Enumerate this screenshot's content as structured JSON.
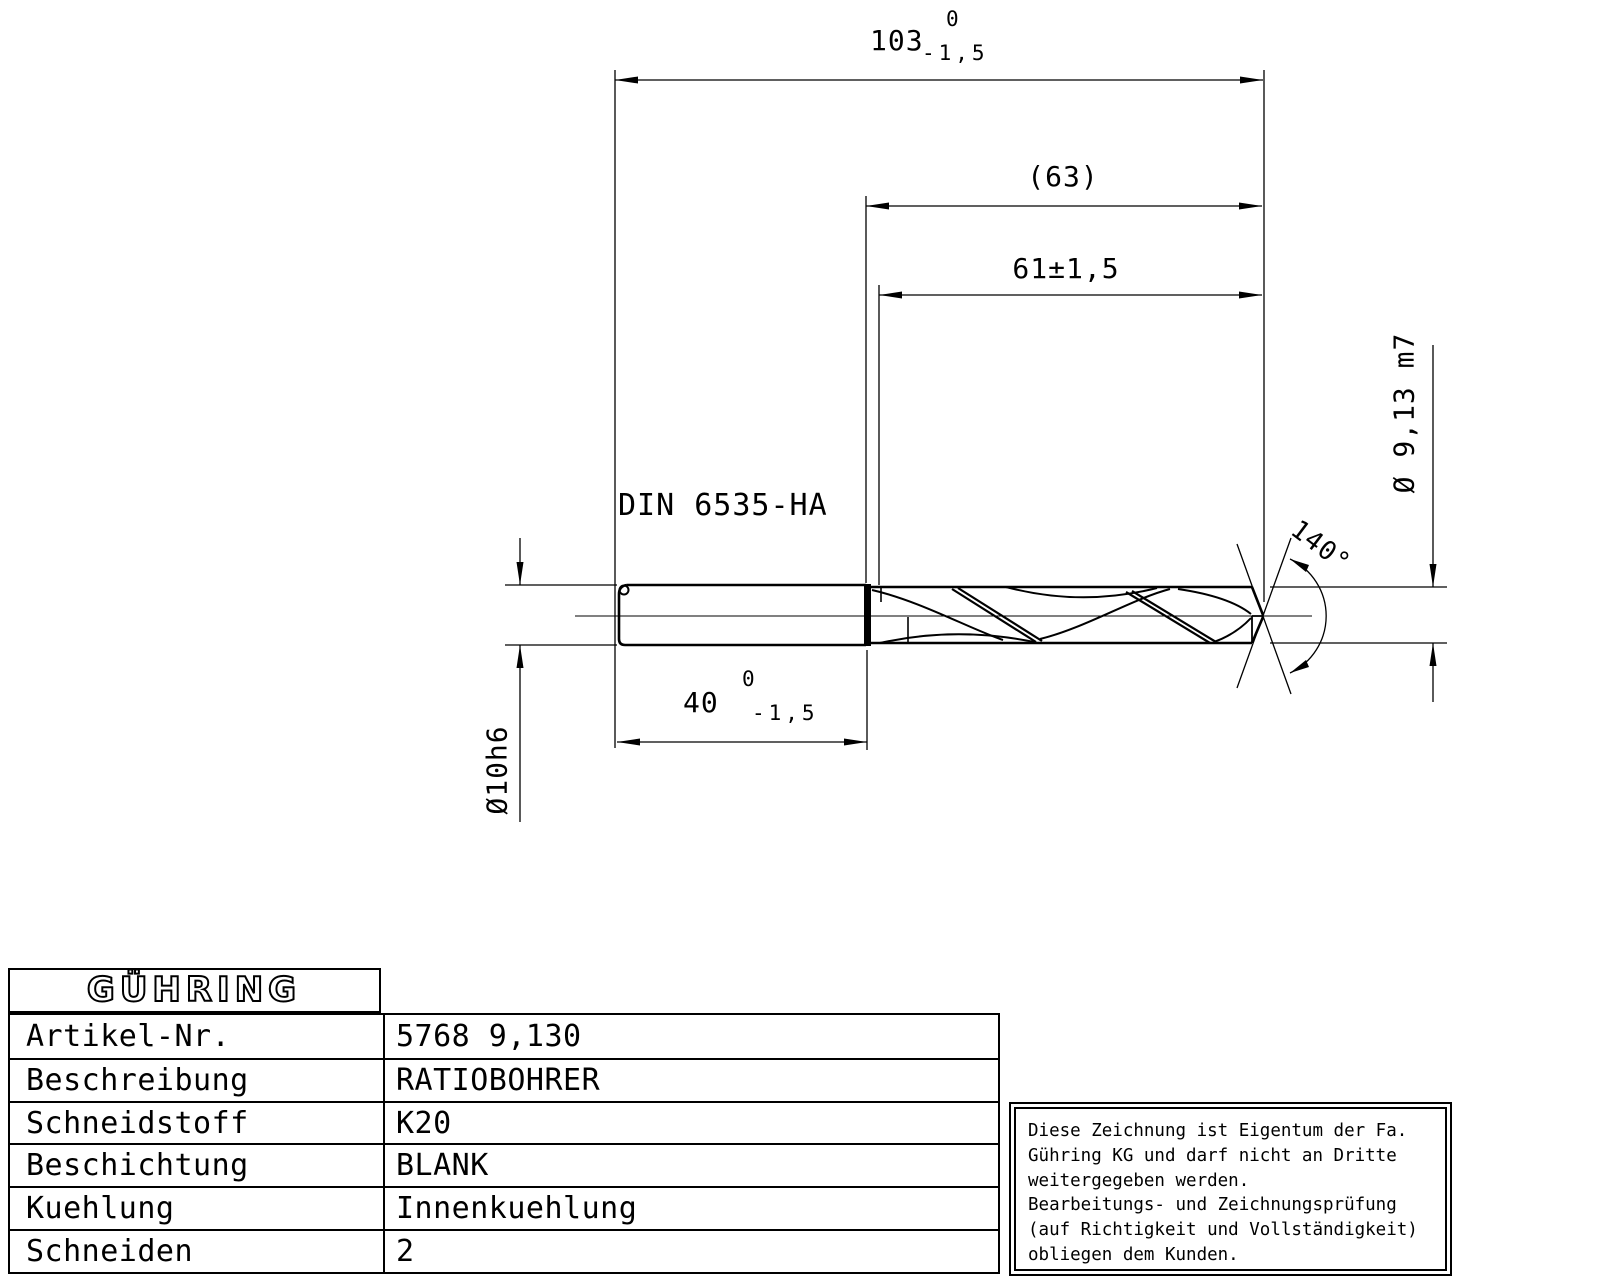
{
  "drawing": {
    "shank_standard": "DIN 6535-HA",
    "dimensions": {
      "overall_length": {
        "main": "103",
        "tol_upper": "0",
        "tol_lower": "-1,5"
      },
      "flute_length_ref": "(63)",
      "flute_length": "61±1,5",
      "shank_length": {
        "main": "40",
        "tol_upper": "0",
        "tol_lower": "-1,5"
      },
      "point_angle": "140°",
      "body_diameter": "Ø 9,13 m7",
      "shank_diameter": "Ø10h6"
    }
  },
  "title_block": {
    "logo": "GÜHRING",
    "rows": [
      {
        "label": "Artikel-Nr.",
        "value": "5768 9,130"
      },
      {
        "label": "Beschreibung",
        "value": "RATIOBOHRER"
      },
      {
        "label": "Schneidstoff",
        "value": "K20"
      },
      {
        "label": "Beschichtung",
        "value": "BLANK"
      },
      {
        "label": "Kuehlung",
        "value": "Innenkuehlung"
      },
      {
        "label": "Schneiden",
        "value": "2"
      }
    ]
  },
  "notice": {
    "lines": [
      "Diese Zeichnung ist Eigentum der Fa.",
      "Gühring KG und darf nicht an Dritte",
      "weitergegeben werden.",
      "Bearbeitungs- und Zeichnungsprüfung",
      "(auf Richtigkeit und Vollständigkeit)",
      "obliegen dem Kunden."
    ]
  }
}
